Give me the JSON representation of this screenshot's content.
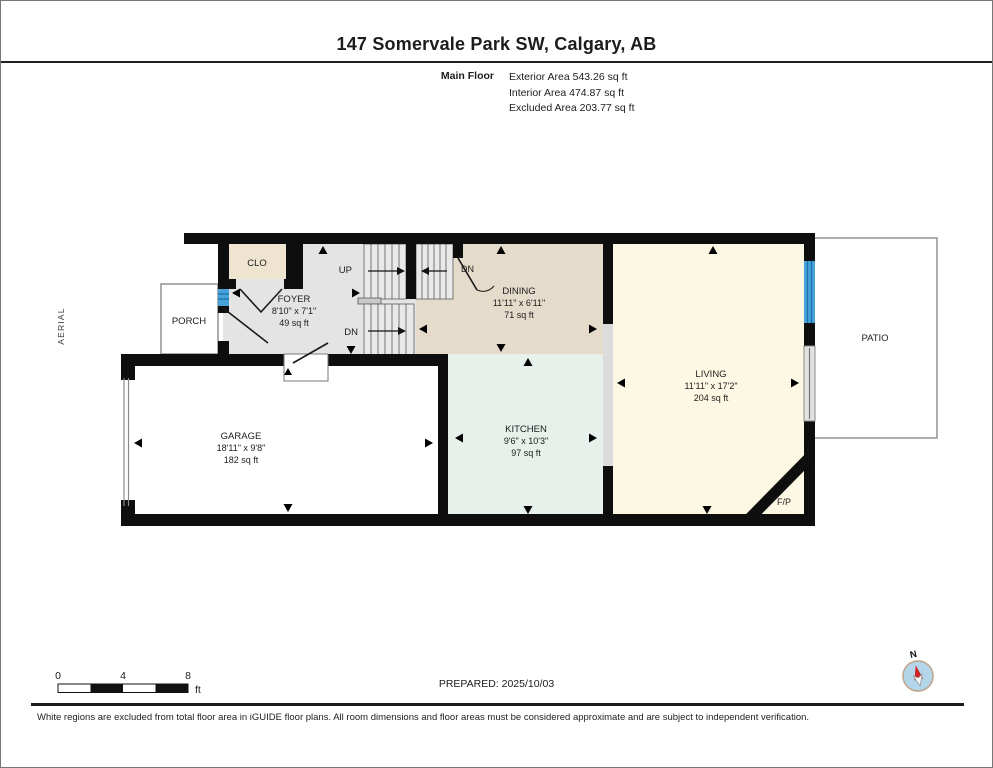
{
  "header": {
    "title": "147 Somervale Park SW, Calgary, AB",
    "floor_label": "Main Floor",
    "area_lines": [
      "Exterior Area 543.26 sq ft",
      "Interior Area 474.87 sq ft",
      "Excluded Area 203.77 sq ft"
    ]
  },
  "plan": {
    "aerial_label": "AERIAL",
    "rooms": {
      "clo": {
        "name": "CLO"
      },
      "porch": {
        "name": "PORCH"
      },
      "foyer": {
        "name": "FOYER",
        "dims": "8'10\" x 7'1\"",
        "area": "49 sq ft"
      },
      "dining": {
        "name": "DINING",
        "dims": "11'11\" x 6'11\"",
        "area": "71 sq ft"
      },
      "living": {
        "name": "LIVING",
        "dims": "11'11\" x 17'2\"",
        "area": "204 sq ft"
      },
      "kitchen": {
        "name": "KITCHEN",
        "dims": "9'6\" x 10'3\"",
        "area": "97 sq ft"
      },
      "garage": {
        "name": "GARAGE",
        "dims": "18'11\" x 9'8\"",
        "area": "182 sq ft"
      },
      "patio": {
        "name": "PATIO"
      },
      "fireplace": {
        "name": "F/P"
      }
    },
    "stairs": {
      "up": "UP",
      "dn": "DN"
    },
    "colors": {
      "wall": "#0e0e0e",
      "foyer_fill": "#e4e4e4",
      "clo_fill": "#efe4d0",
      "dining_fill": "#e5dbcb",
      "kitchen_fill": "#e7f0ea",
      "living_fill": "#fdf8e3",
      "window_blue": "#46a2d9",
      "compass_red": "#cf2127"
    }
  },
  "footer": {
    "prepared": "PREPARED: 2025/10/03",
    "scale": {
      "t0": "0",
      "t4": "4",
      "t8": "8",
      "unit": "ft"
    },
    "compass_n": "N",
    "disclaimer": "White regions are excluded from total floor area in iGUIDE floor plans. All room dimensions and floor areas must be considered approximate and are subject to independent verification."
  }
}
